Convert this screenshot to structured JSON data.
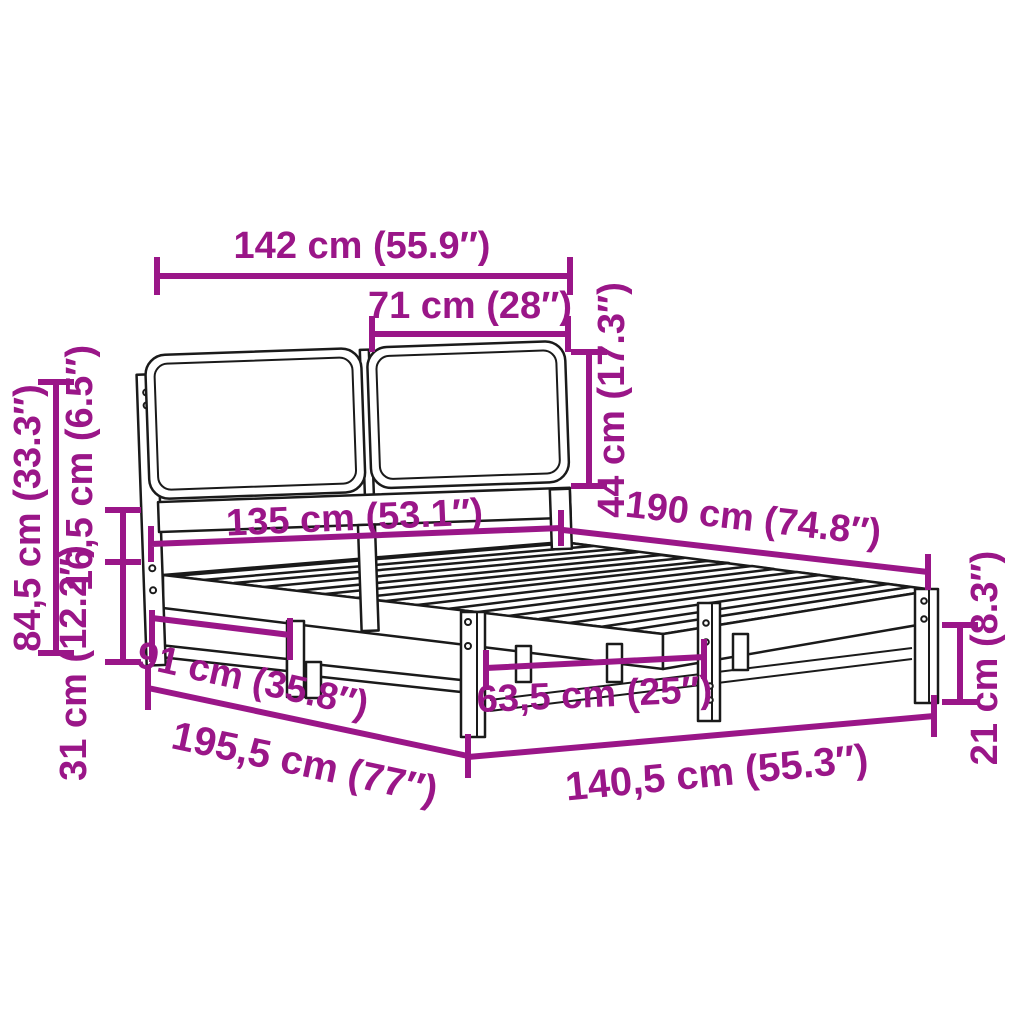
{
  "diagram_type": "product-dimensions",
  "subject": "bed frame with slatted base and two-panel cushioned headboard",
  "colors": {
    "accent": "#9A1688",
    "line": "#1A1A1A",
    "background": "#FFFFFF"
  },
  "dimensions": {
    "headboard_width": "142 cm (55.9″)",
    "headboard_panel_width": "71 cm (28″)",
    "headboard_panel_height": "44 cm (17.3″)",
    "headboard_total_height": "84,5 cm (33.3″)",
    "side_rail_height": "16,5 cm (6.5″)",
    "frame_height": "31 cm (12.2″)",
    "slatted_base_width": "135 cm (53.1″)",
    "bed_length": "190 cm (74.8″)",
    "headboard_to_leg_span": "91 cm (35.8″)",
    "total_length": "195,5 cm (77″)",
    "leg_spacing": "63,5 cm (25″)",
    "frame_outer_width": "140,5 cm (55.3″)",
    "underbed_clearance": "21 cm (8.3″)"
  }
}
